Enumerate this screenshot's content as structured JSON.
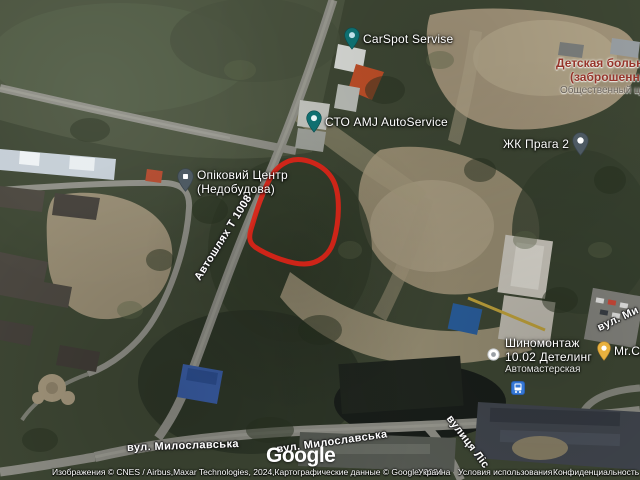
{
  "pois": {
    "carspot": {
      "label": "CarSpot Servise"
    },
    "hospital": {
      "line1": "Детская больница",
      "line2": "(заброшенная",
      "line3": "Общественный центр"
    },
    "sto_amj": {
      "label": "СТО AMJ AutoService"
    },
    "zhk_praga": {
      "label": "ЖК Прага 2"
    },
    "opikovyi": {
      "line1": "Опіковий Центр",
      "line2": "(Недобудова)"
    },
    "shinomontazh": {
      "line1": "Шиномонтаж",
      "line2": "10.02 Детелинг",
      "line3": "Автомастерская"
    },
    "mr_ca": {
      "label": "Mr.Ca"
    }
  },
  "roads": {
    "t1008": {
      "label": "Автошлях Т 1008"
    },
    "myloslavska_w": {
      "label": "вул. Милославська"
    },
    "myloslavska_e": {
      "label": "вул. Милославська"
    },
    "mylo_edge": {
      "label": "вул. Ми"
    },
    "lisova": {
      "label": "вулиця Ліс"
    }
  },
  "footer": {
    "logo": "Google",
    "attribution": "Изображения © CNES / Airbus,Maxar Technologies, 2024,Картографические данные © Google, 2024",
    "country": "Украина",
    "terms": "Условия использования",
    "privacy": "Конфиденциальность"
  },
  "colors": {
    "annotation_red": "#da2318",
    "pin_teal": "#0f6f70",
    "pin_gray": "#4e5a63",
    "pin_yellow": "#e9b13e",
    "transit_blue": "#3477d6",
    "hospital_label": "#96352b"
  }
}
